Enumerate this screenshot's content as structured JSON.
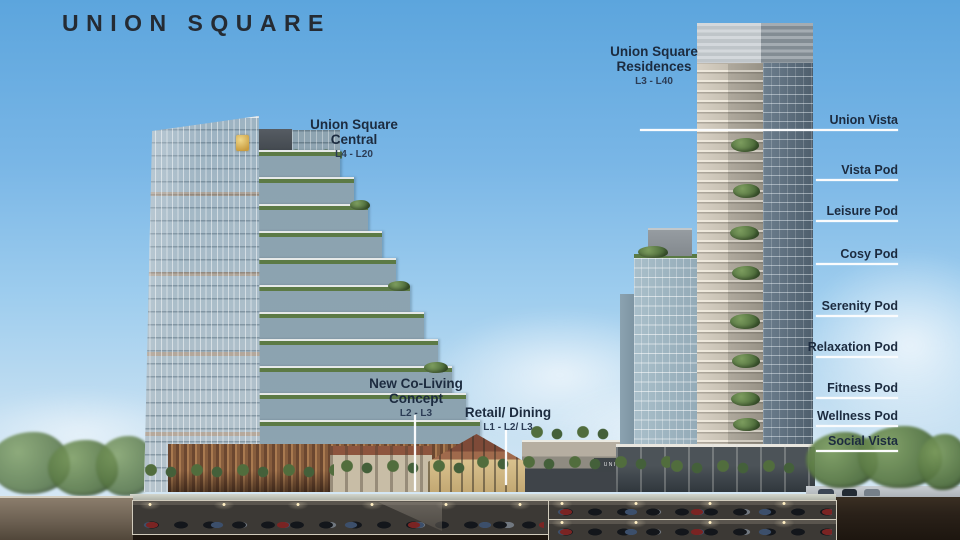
{
  "brand": {
    "title": "UNION SQUARE"
  },
  "callouts": {
    "central": {
      "line1": "Union Square",
      "line2": "Central",
      "levels": "L4 - L20"
    },
    "residences": {
      "line1": "Union Square",
      "line2": "Residences",
      "levels": "L3 - L40"
    },
    "coliving": {
      "line1": "New Co-Living",
      "line2": "Concept",
      "levels": "L2 - L3"
    },
    "retail": {
      "line1": "Retail/ Dining",
      "levels": "L1 - L2/ L3"
    }
  },
  "right_labels": [
    {
      "text": "Union Vista"
    },
    {
      "text": "Vista Pod"
    },
    {
      "text": "Leisure Pod"
    },
    {
      "text": "Cosy Pod"
    },
    {
      "text": "Serenity Pod"
    },
    {
      "text": "Relaxation Pod"
    },
    {
      "text": "Fitness Pod"
    },
    {
      "text": "Wellness Pod"
    },
    {
      "text": "Social Vista"
    }
  ],
  "signage": {
    "podium": "UNION SQUARE"
  },
  "colors": {
    "sky_top": "#5ca5dd",
    "sky_bottom": "#dcebf5",
    "brand_text": "#252b33",
    "annotation_text": "#1c2b3f",
    "leader_line": "#ffffff",
    "gold_logo": "#d8b65e",
    "terracotta_roof": "#8d553e",
    "greenery": "#4a6a38",
    "earth": "#2a2119"
  }
}
